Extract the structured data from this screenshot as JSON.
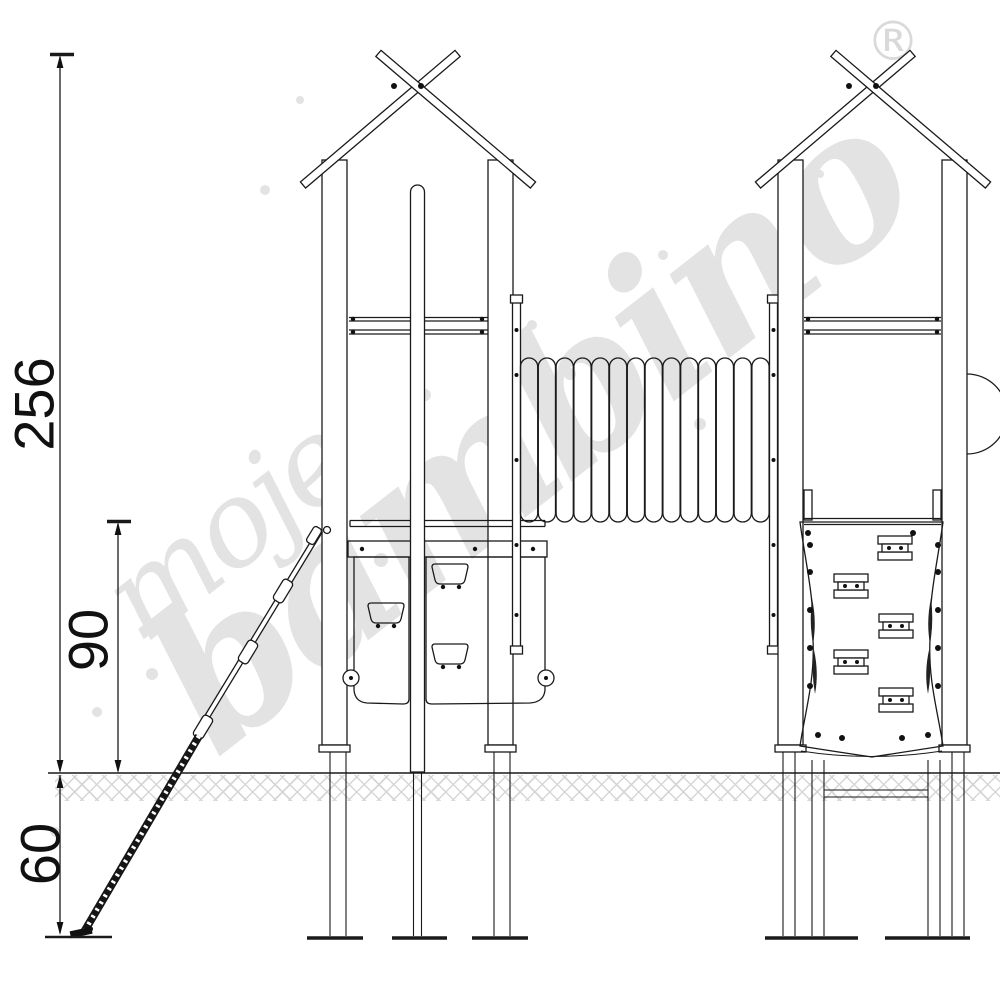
{
  "page": {
    "background": "#ffffff"
  },
  "drawing": {
    "type": "technical-diagram",
    "subject": "playground double-tower set with corrugated tunnel bridge, rope climber, side elevation",
    "dimension_labels": {
      "total_height": "256",
      "deck_height": "90",
      "foundation_depth": "60"
    },
    "watermark": {
      "word1": "moje",
      "word2": "bambino",
      "registered_mark": "®"
    },
    "tunnel": {
      "rib_count": 14
    },
    "colors": {
      "line": "#1a1a1a",
      "watermark": "#e3e3e3",
      "hatch": "#cfcfcf",
      "bolt": "#111111"
    }
  }
}
